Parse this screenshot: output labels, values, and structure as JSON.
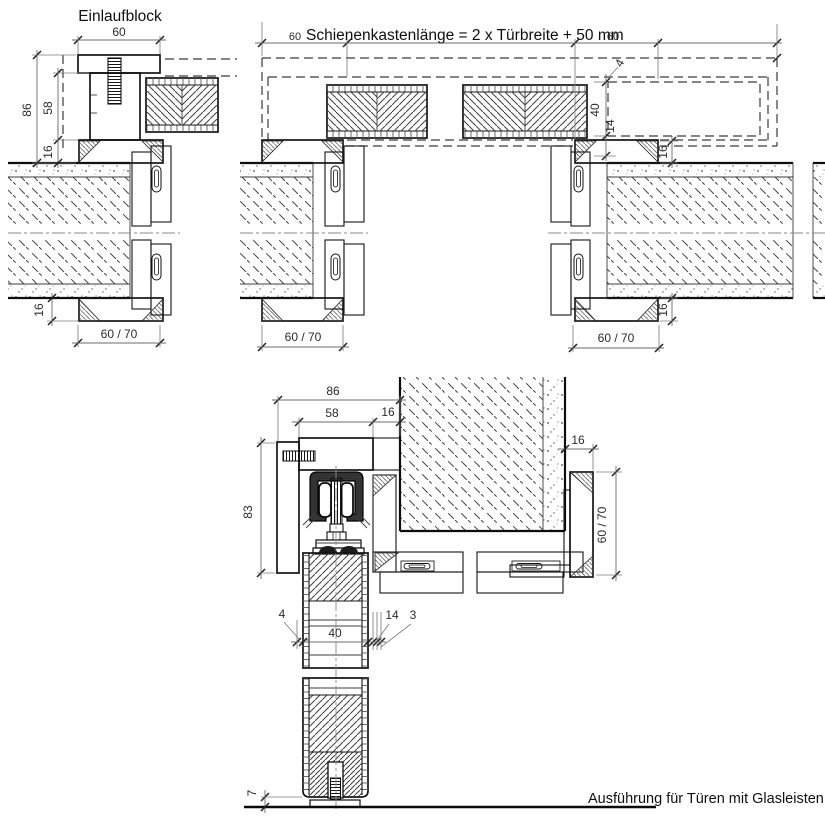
{
  "titles": {
    "einlaufblock": "Einlaufblock",
    "rail_formula": "Schienenkastenlänge = 2 x Türbreite + 50 mm",
    "footer_note": "Ausführung für Türen mit Glasleisten"
  },
  "detail_einlaufblock": {
    "dim_width_60": "60",
    "dim_depth_86": "86",
    "dim_block_58": "58",
    "dim_overlap_top_16": "16",
    "dim_overlap_bottom_16": "16",
    "dim_frame_60_70": "60 / 70"
  },
  "plan_section": {
    "dim_left_60": "60",
    "dim_right_60": "60",
    "dim_clearance_4": "4",
    "dim_rail_40": "40",
    "dim_14": "14",
    "dim_jamb_left_60_70": "60 / 70",
    "dim_jamb_right_60_70": "60 / 70",
    "dim_overlap_top_16": "16",
    "dim_overlap_bottom_16": "16"
  },
  "vertical_section": {
    "dim_86": "86",
    "dim_58": "58",
    "dim_16_top": "16",
    "dim_pelmet_83": "83",
    "dim_frame_16": "16",
    "dim_frame_60_70": "60 / 70",
    "dim_gap_4": "4",
    "dim_door_40": "40",
    "dim_14": "14",
    "dim_3": "3",
    "dim_floor_7": "7"
  }
}
